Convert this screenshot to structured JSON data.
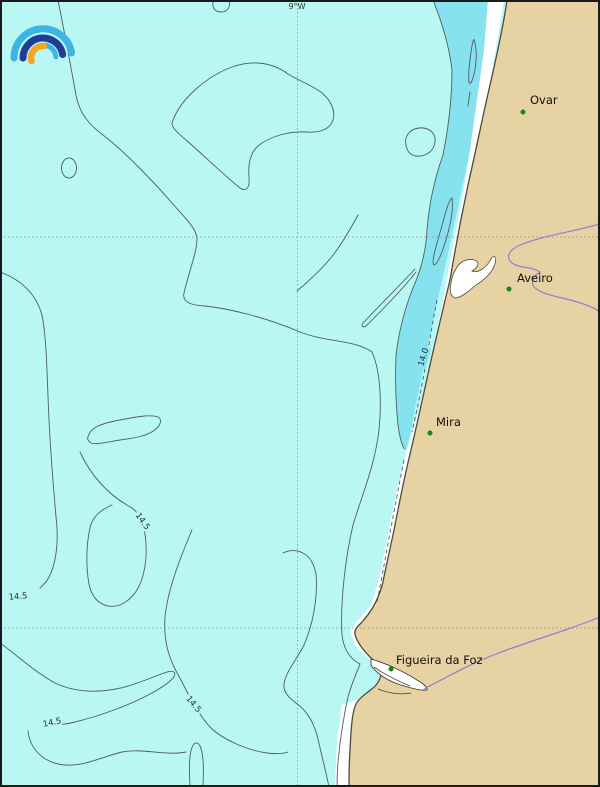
{
  "map": {
    "meridian_label": "9°W",
    "cities": [
      {
        "name": "Ovar"
      },
      {
        "name": "Aveiro"
      },
      {
        "name": "Mira"
      },
      {
        "name": "Figueira da Foz"
      }
    ],
    "contour_labels": {
      "c14_0": "14.0",
      "c14_5_a": "14.5",
      "c14_5_b": "14.5",
      "c14_5_c": "14.5",
      "c14_5_d": "14.5"
    },
    "colors": {
      "ocean": "#b9f7f2",
      "cold_water_band": "#87e2ef",
      "land": "#e6d2a2",
      "beach": "#ffffff",
      "contour_line": "#4f5d60",
      "coastline": "#4c4b41",
      "river": "#9080cc",
      "grid": "#8a8a8a",
      "city_marker": "#0a930a",
      "logo_light_blue": "#3cb4e5",
      "logo_dark_blue": "#1d3e94",
      "logo_orange": "#f7a423"
    }
  }
}
